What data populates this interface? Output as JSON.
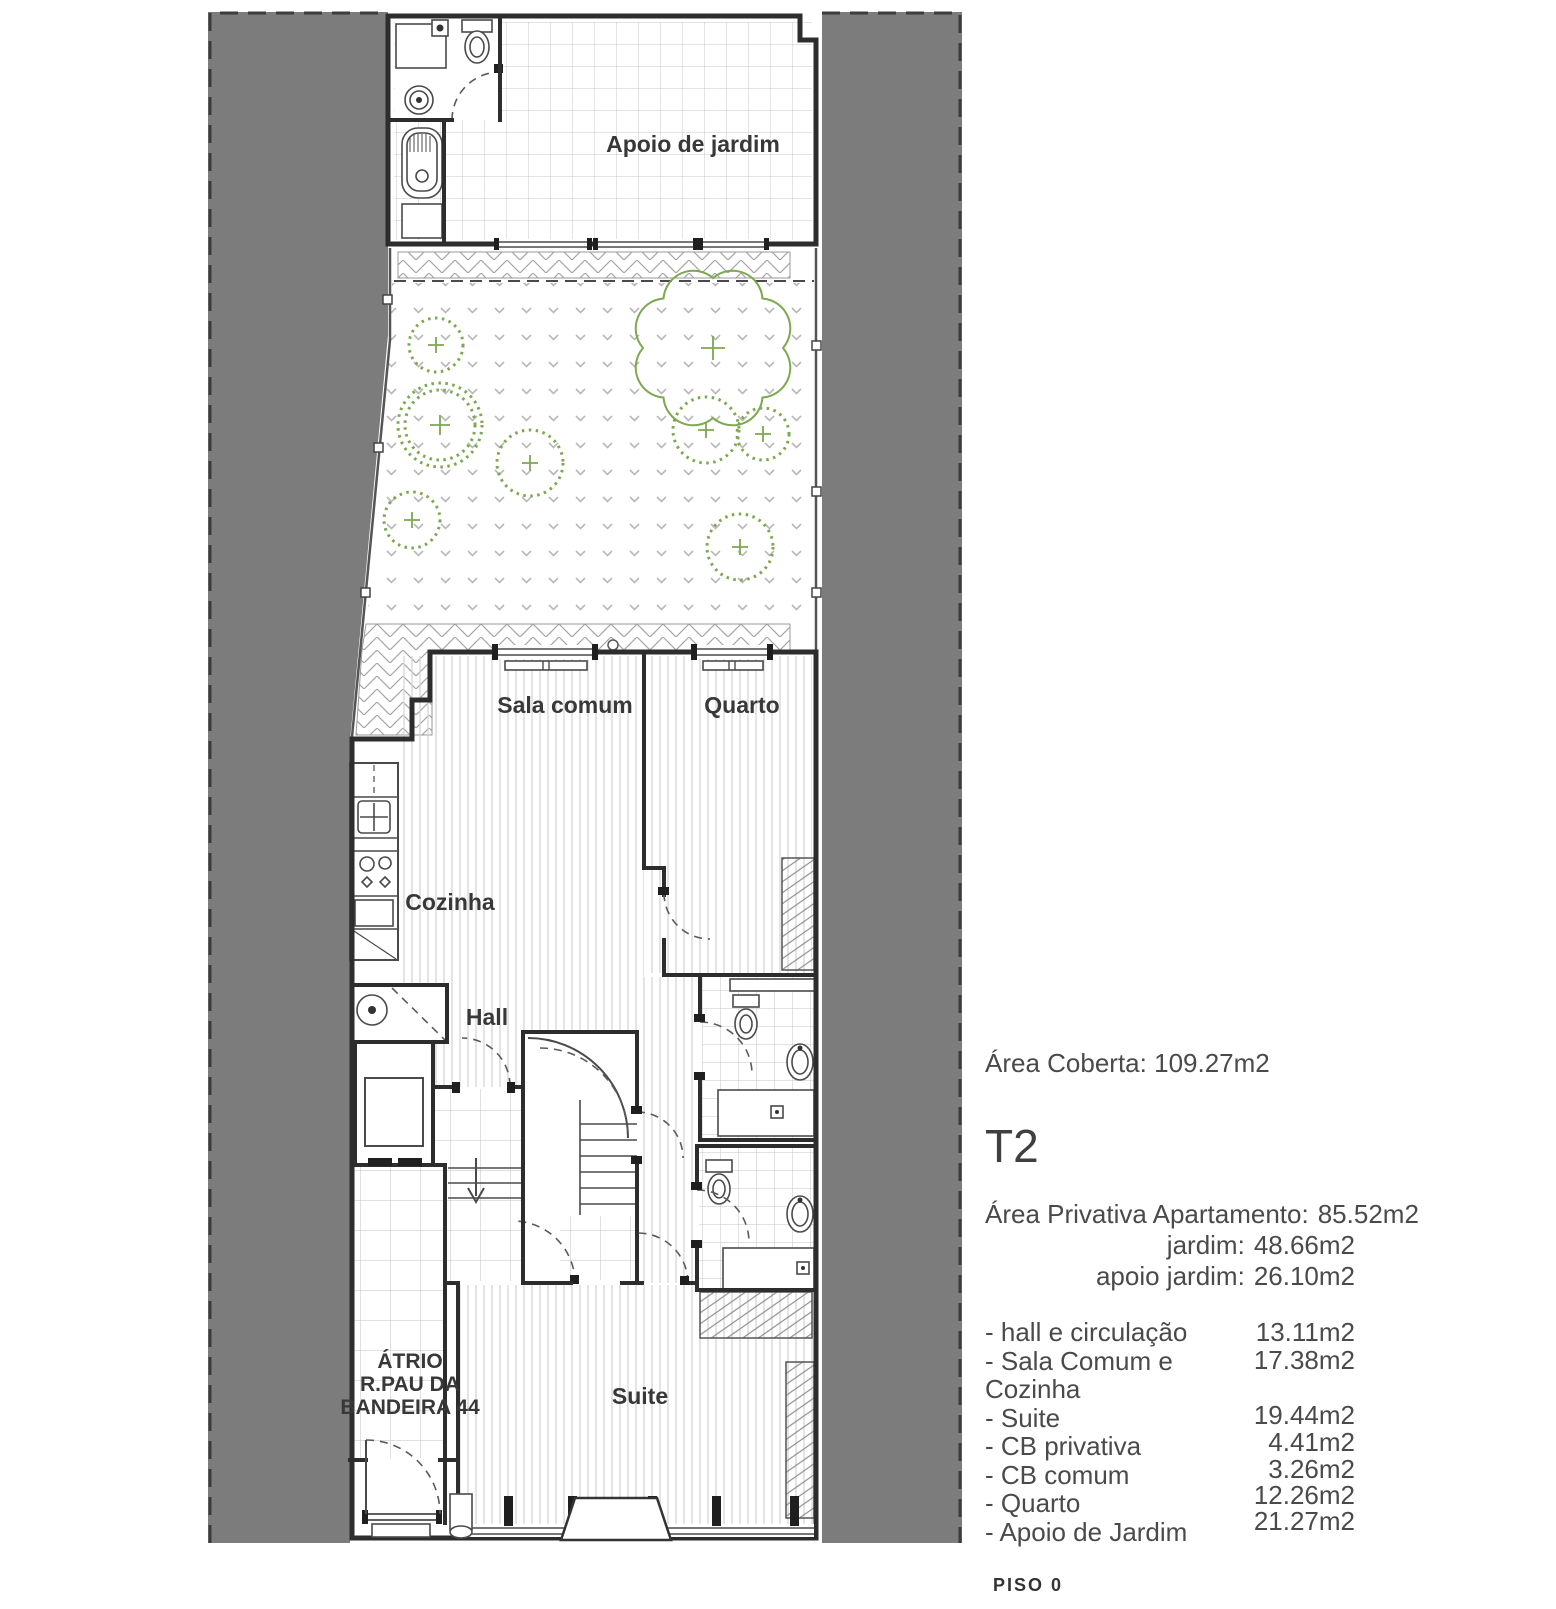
{
  "plan": {
    "labels": {
      "apoio": "Apoio de jardim",
      "sala": "Sala comum",
      "quarto": "Quarto",
      "cozinha": "Cozinha",
      "hall": "Hall",
      "atrio1": "ÁTRIO",
      "atrio2": "R.PAU DA",
      "atrio3": "BANDEIRA 44",
      "suite": "Suite"
    },
    "floor_label": "PISO 0"
  },
  "info": {
    "area_coberta_label": "Área Coberta:",
    "area_coberta_value": "109.27m2",
    "typology": "T2",
    "private_areas": [
      {
        "label": "Área Privativa Apartamento:",
        "value": "85.52m2"
      },
      {
        "label": "jardim:",
        "value": "48.66m2"
      },
      {
        "label": "apoio jardim:",
        "value": "26.10m2"
      }
    ],
    "room_areas": [
      {
        "label": "- hall e circulação",
        "value": "13.11m2"
      },
      {
        "label": "- Sala Comum e Cozinha",
        "value": "17.38m2"
      },
      {
        "label": "- Suite",
        "value": "19.44m2"
      },
      {
        "label": "- CB privativa",
        "value": "4.41m2"
      },
      {
        "label": "- CB comum",
        "value": "3.26m2"
      },
      {
        "label": "- Quarto",
        "value": "12.26m2"
      },
      {
        "label": "- Apoio de Jardim",
        "value": "21.27m2"
      }
    ]
  },
  "colors": {
    "neighbor_gray": "#7c7c7c",
    "wall": "#2d2d2d",
    "vegetation_green": "#7ca84f",
    "text": "#4a4a4a"
  }
}
